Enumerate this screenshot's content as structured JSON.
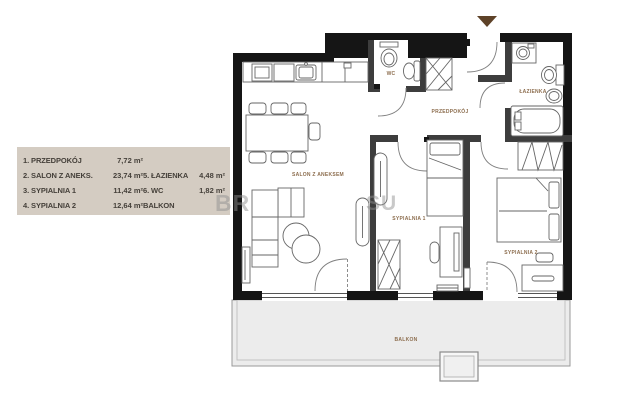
{
  "legend": {
    "rows": [
      {
        "left_name": "1. PRZEDPOKÓJ",
        "left_area": "7,72 m²",
        "right_name": "",
        "right_area": ""
      },
      {
        "left_name": "2. SALON Z ANEKS.",
        "left_area": "23,74 m²",
        "right_name": "5. ŁAZIENKA",
        "right_area": "4,48 m²"
      },
      {
        "left_name": "3. SYPIALNIA 1",
        "left_area": "11,42 m²",
        "right_name": "6. WC",
        "right_area": "1,82 m²"
      },
      {
        "left_name": "4. SYPIALNIA 2",
        "left_area": "12,64 m²",
        "right_name": "BALKON",
        "right_area": ""
      }
    ]
  },
  "plan": {
    "room_labels": {
      "przedpokoj": "PRZEDPOKÓJ",
      "wc": "WC",
      "lazienka": "ŁAZIENKA",
      "salon": "SALON Z ANEKSEM",
      "sypialnia1": "SYPIALNIA 1",
      "sypialnia2": "SYPIALNIA 2",
      "balkon": "BALKON"
    }
  },
  "watermark": {
    "left": "BR",
    "right": "SU"
  },
  "colors": {
    "wall": "#151515",
    "interior_wall": "#3d3d3d",
    "furniture_stroke": "#666666",
    "label_brown": "#8d6e4f",
    "legend_bg": "#d4ccc2",
    "legend_text": "#45403a",
    "balcony_fill": "#ececec",
    "entrance_marker": "#5e4228",
    "watermark_gray": "#8f8f8f"
  }
}
